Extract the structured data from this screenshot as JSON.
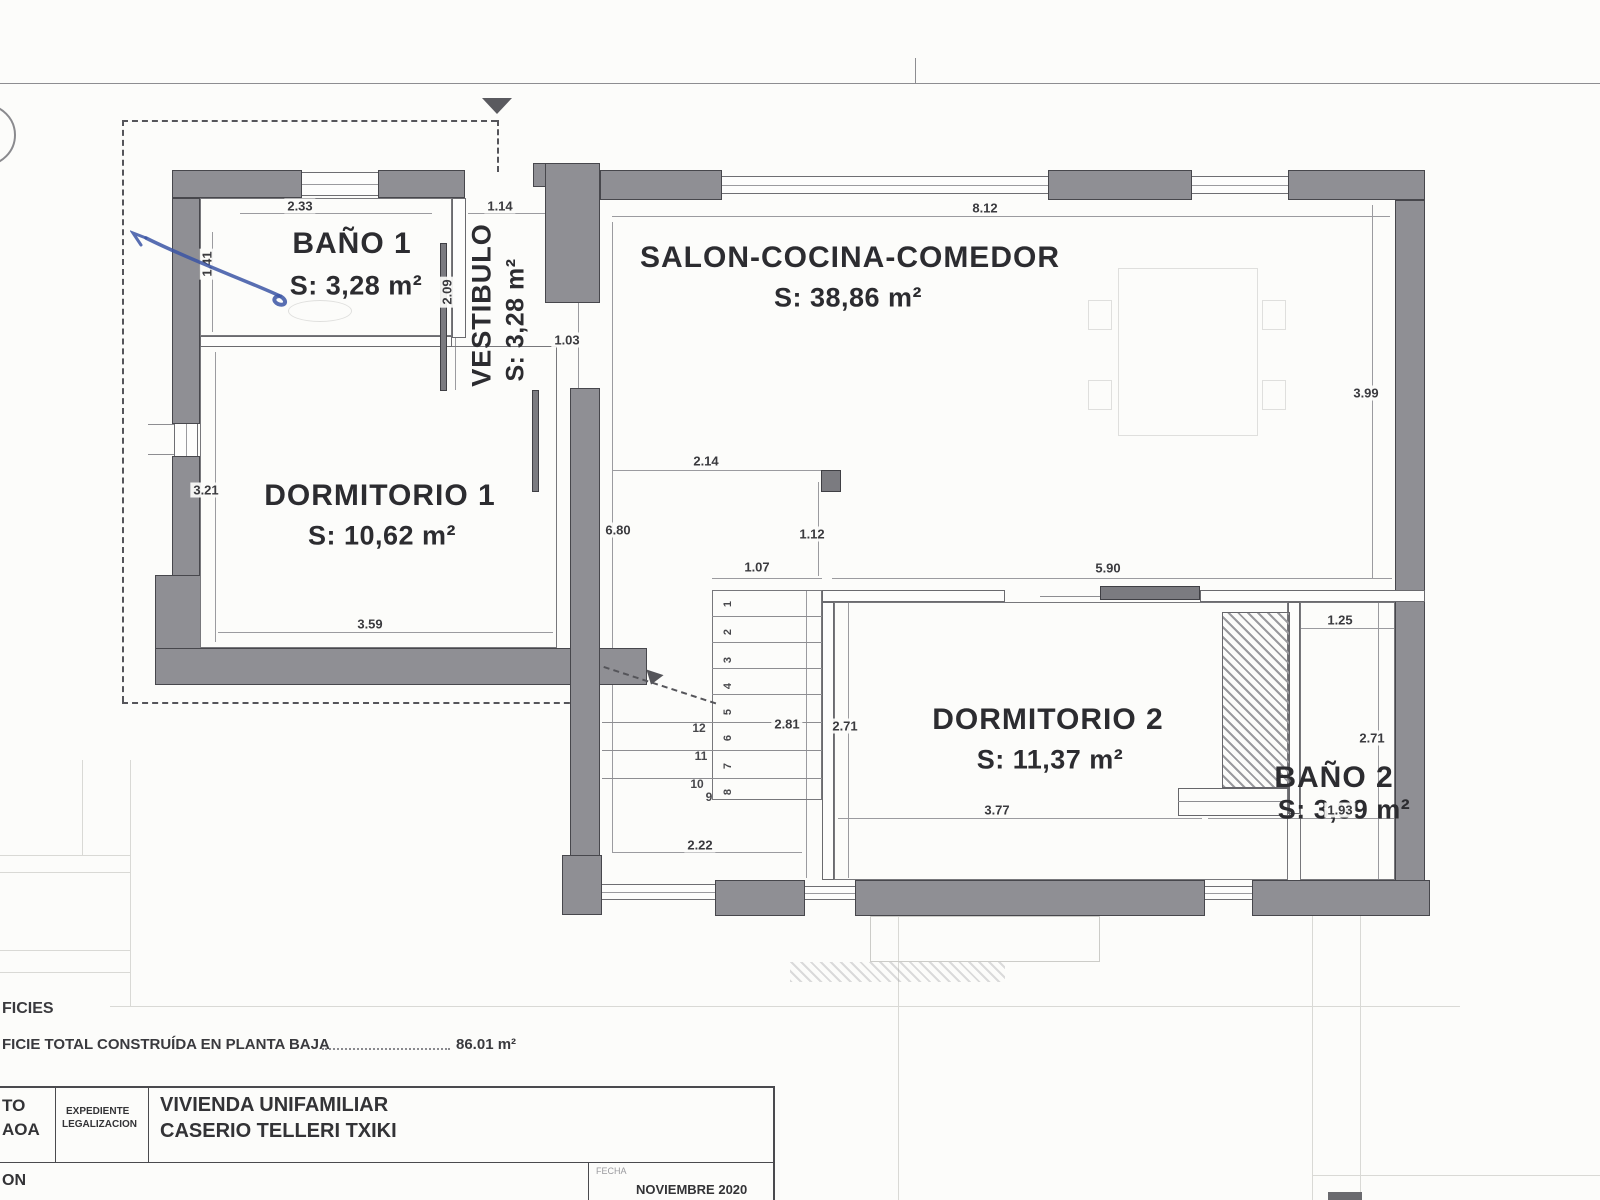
{
  "rooms": {
    "bano1": {
      "name": "BAÑO 1",
      "area": "S: 3,28 m²"
    },
    "vestibulo": {
      "name": "VESTIBULO",
      "area": "S: 3,28 m²"
    },
    "salon": {
      "name": "SALON-COCINA-COMEDOR",
      "area": "S: 38,86 m²"
    },
    "dorm1": {
      "name": "DORMITORIO 1",
      "area": "S: 10,62 m²"
    },
    "dorm2": {
      "name": "DORMITORIO 2",
      "area": "S: 11,37 m²"
    },
    "bano2": {
      "name": "BAÑO 2",
      "area": "S: 3,99 m²"
    }
  },
  "dims": {
    "d233": "2.33",
    "d114": "1.14",
    "d812": "8.12",
    "d209": "2.09",
    "d141": "1.41",
    "d103": "1.03",
    "d321": "3.21",
    "d680": "6.80",
    "d214": "2.14",
    "d112": "1.12",
    "d107": "1.07",
    "d590": "5.90",
    "d399": "3.99",
    "d125": "1.25",
    "d281": "2.81",
    "d271a": "2.71",
    "d271b": "2.71",
    "d359": "3.59",
    "d377": "3.77",
    "d193": "1.93",
    "d222": "2.22"
  },
  "stairs": {
    "left": [
      "12",
      "11",
      "10",
      "9"
    ],
    "steps": [
      "1",
      "2",
      "3",
      "4",
      "5",
      "6",
      "7",
      "8"
    ]
  },
  "notes": {
    "superficies_label": "FICIES",
    "total_line": "FICIE TOTAL CONSTRUÍDA EN PLANTA BAJA",
    "total_value": "86.01 m²"
  },
  "titleblock": {
    "col1_line1": "TO",
    "col1_line2": "AOA",
    "col2_line1": "EXPEDIENTE",
    "col2_line2": "LEGALIZACION",
    "project_line1": "VIVIENDA UNIFAMILIAR",
    "project_line2": "CASERIO TELLERI TXIKI",
    "row2_left": "ON",
    "fecha_label": "FECHA",
    "fecha_value": "NOVIEMBRE  2020"
  },
  "colors": {
    "wall": "#8f8f94",
    "ink": "#2e2e32",
    "pen": "#3b55a5"
  }
}
